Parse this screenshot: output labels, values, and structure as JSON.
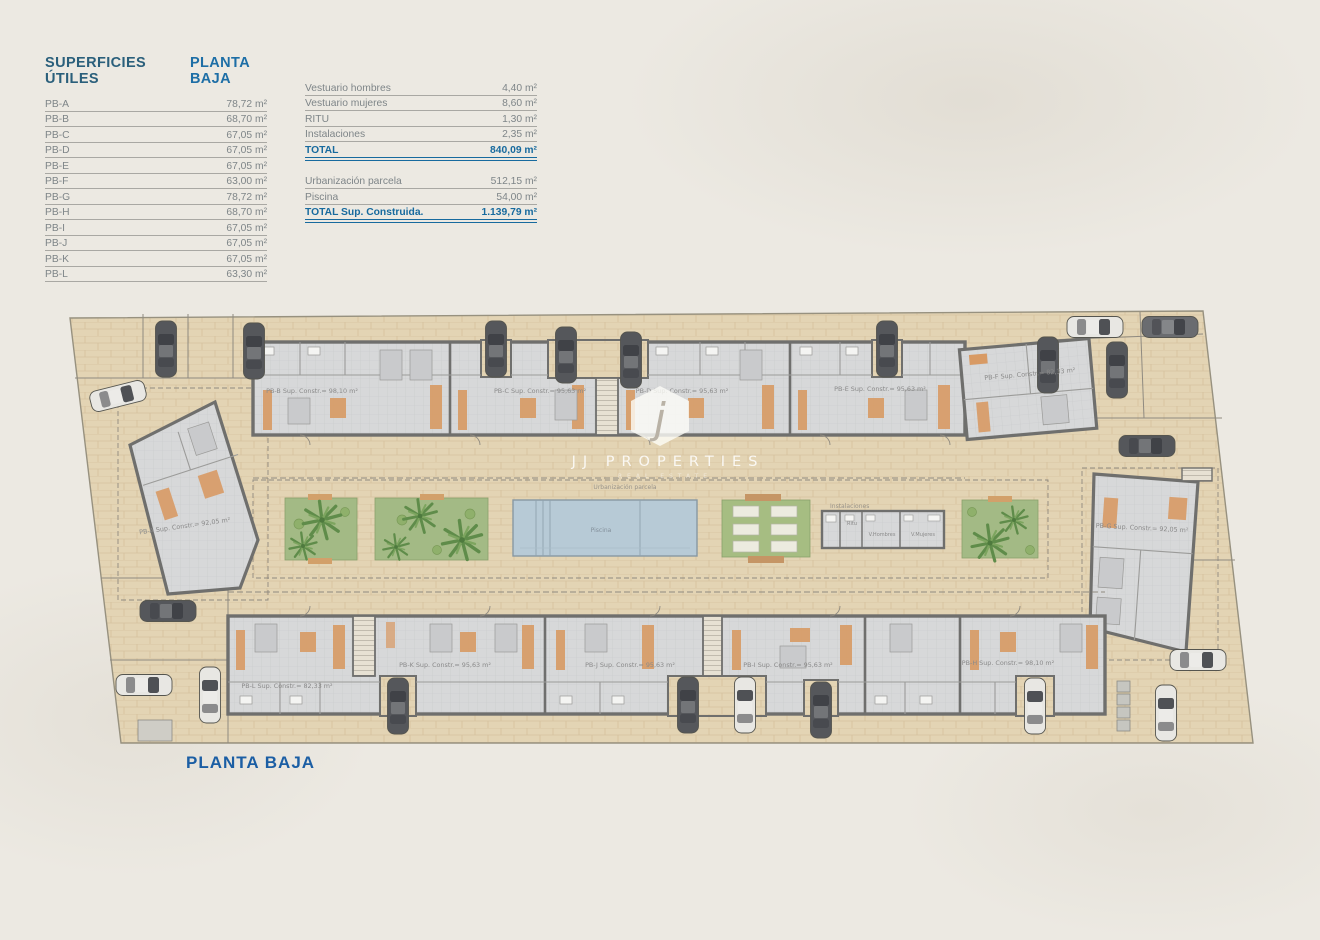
{
  "tables": {
    "left": {
      "title_col1": "SUPERFICIES ÚTILES",
      "title_col2": "PLANTA BAJA",
      "rows": [
        {
          "label": "PB-A",
          "value": "78,72 m²"
        },
        {
          "label": "PB-B",
          "value": "68,70 m²"
        },
        {
          "label": "PB-C",
          "value": "67,05 m²"
        },
        {
          "label": "PB-D",
          "value": "67,05 m²"
        },
        {
          "label": "PB-E",
          "value": "67,05 m²"
        },
        {
          "label": "PB-F",
          "value": "63,00 m²"
        },
        {
          "label": "PB-G",
          "value": "78,72 m²"
        },
        {
          "label": "PB-H",
          "value": "68,70 m²"
        },
        {
          "label": "PB-I",
          "value": "67,05 m²"
        },
        {
          "label": "PB-J",
          "value": "67,05 m²"
        },
        {
          "label": "PB-K",
          "value": "67,05 m²"
        },
        {
          "label": "PB-L",
          "value": "63,30 m²"
        }
      ]
    },
    "right": {
      "rows": [
        {
          "label": "Vestuario hombres",
          "value": "4,40 m²"
        },
        {
          "label": "Vestuario mujeres",
          "value": "8,60 m²"
        },
        {
          "label": "RITU",
          "value": "1,30 m²"
        },
        {
          "label": "Instalaciones",
          "value": "2,35 m²"
        }
      ],
      "total": {
        "label": "TOTAL",
        "value": "840,09 m²"
      },
      "rows2": [
        {
          "label": "Urbanización parcela",
          "value": "512,15 m²"
        },
        {
          "label": "Piscina",
          "value": "54,00 m²"
        }
      ],
      "total2": {
        "label": "TOTAL Sup. Construida.",
        "value": "1.139,79 m²"
      }
    }
  },
  "plan": {
    "caption": "PLANTA BAJA",
    "watermark": {
      "letter": "j",
      "name": "JJ PROPERTIES",
      "tagline": "REAL ESTATE"
    },
    "labels": {
      "urbanizacion": "Urbanización parcela",
      "piscina": "Piscina",
      "instalaciones": "Instalaciones",
      "ritu": "Ritu",
      "v_hombres": "V.Hombres",
      "v_mujeres": "V.Mujeres"
    },
    "units": {
      "pba": {
        "label": "PB-A Sup. Constr.= 92,05 m²"
      },
      "pbb": {
        "label": "PB-B Sup. Constr.= 98,10 m²"
      },
      "pbc": {
        "label": "PB-C Sup. Constr.= 95,63 m²"
      },
      "pbd": {
        "label": "PB-D Sup. Constr.= 95,63 m²"
      },
      "pbe": {
        "label": "PB-E Sup. Constr.= 95,63 m²"
      },
      "pbf": {
        "label": "PB-F Sup. Constr.= 82,33 m²"
      },
      "pbg": {
        "label": "PB-G Sup. Constr.= 92,05 m²"
      },
      "pbh": {
        "label": "PB-H Sup. Constr.= 98,10 m²"
      },
      "pbi": {
        "label": "PB-I Sup. Constr.= 95,63 m²"
      },
      "pbj": {
        "label": "PB-J Sup. Constr.= 95,63 m²"
      },
      "pbk": {
        "label": "PB-K Sup. Constr.= 95,63 m²"
      },
      "pbl": {
        "label": "PB-L Sup. Constr.= 82,33 m²"
      }
    },
    "colors": {
      "paving": "#e3d4b4",
      "wall": "#6f6f6d",
      "interior": "#d8d9da",
      "accent_orange": "#d89a64",
      "pool": "#b7cad6",
      "garden": "#a3ba85",
      "heading_blue": "#1d6ea6",
      "heading_teal": "#2a5f7b"
    }
  }
}
